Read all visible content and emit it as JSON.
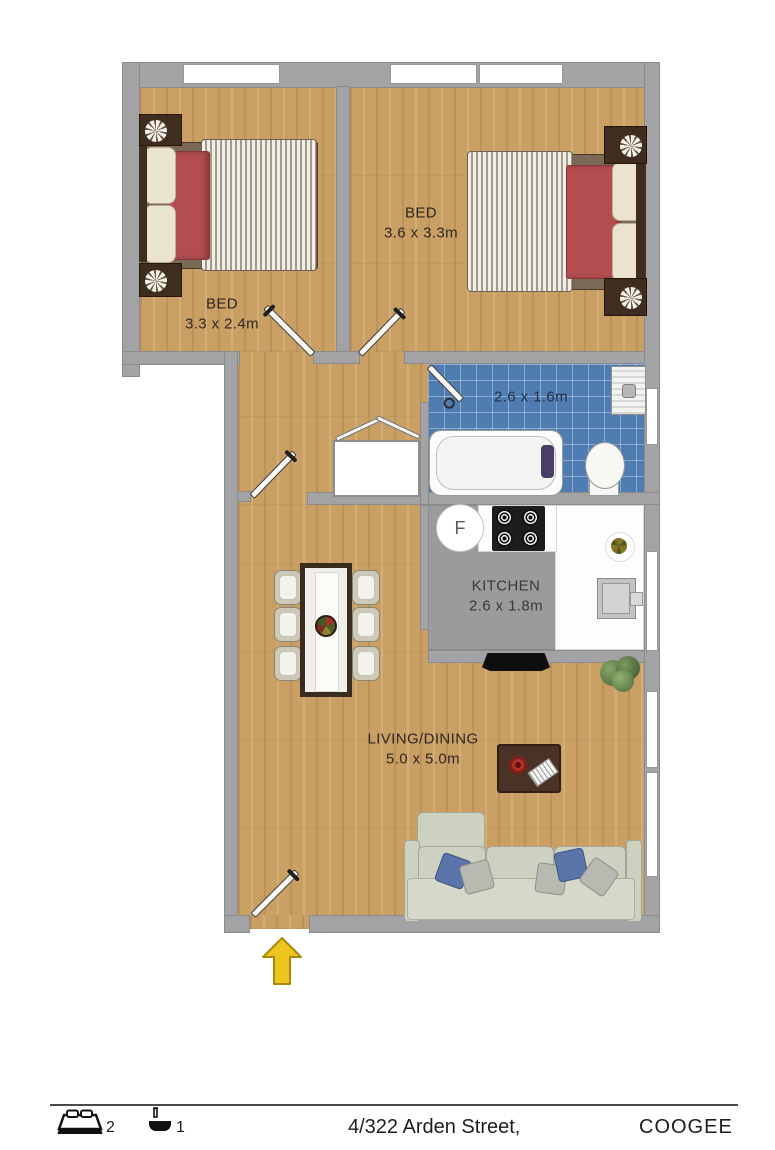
{
  "plan": {
    "rooms": {
      "bed1": {
        "label": "BED",
        "dims": "3.3 x 2.4m"
      },
      "bed2": {
        "label": "BED",
        "dims": "3.6 x 3.3m"
      },
      "bathroom": {
        "dims": "2.6 x 1.6m"
      },
      "kitchen": {
        "label": "KITCHEN",
        "dims": "2.6 x 1.8m"
      },
      "living": {
        "label": "LIVING/DINING",
        "dims": "5.0 x 5.0m"
      }
    },
    "fridge_label": "F",
    "icons": [
      "entry-arrow-icon"
    ],
    "colors": {
      "wall": "#a3a3a5",
      "wood_floor": "#c99f64",
      "bathroom_tile": "#4f7db2",
      "kitchen_floor": "#9b9b9d",
      "entry_arrow": "#eec41f",
      "bed_blanket": "#b34d4f"
    }
  },
  "footer": {
    "bedrooms_count": "2",
    "bathrooms_count": "1",
    "address": "4/322 Arden Street,",
    "suburb": "COOGEE",
    "icons": [
      "bed-icon",
      "bath-icon"
    ]
  }
}
